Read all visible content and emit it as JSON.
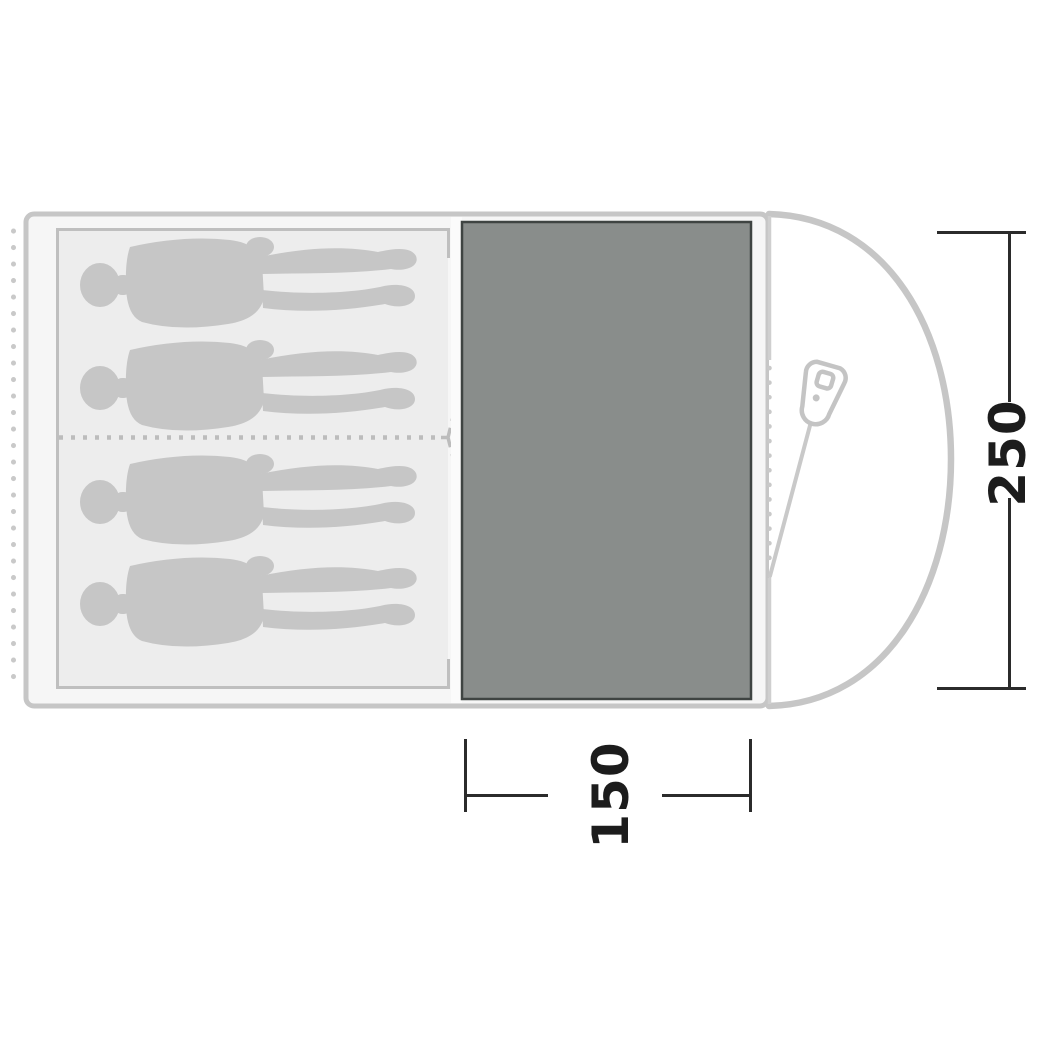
{
  "diagram": {
    "kind": "tent-floorplan-top-view",
    "sleeping_figures_count": 4,
    "dimensions": {
      "right": {
        "label": "250"
      },
      "bottom": {
        "label": "150"
      }
    },
    "icons": {
      "zipper_pull": "zipper-pull-icon",
      "person": "person-silhouette"
    },
    "colors": {
      "tent_outline": "#c6c6c6",
      "tent_fill": "#f6f6f6",
      "inner_cabin_fill": "#ededed",
      "inner_cabin_border": "#bfbfbf",
      "person_fill": "#c6c6c6",
      "floor_fill": "#898d8b",
      "floor_border": "#3f4442",
      "dashed_lines": "#bcbcbc",
      "dimension_line": "#2b2b2b",
      "dimension_text": "#1c1c1c",
      "porch_fill": "#ffffff"
    }
  }
}
